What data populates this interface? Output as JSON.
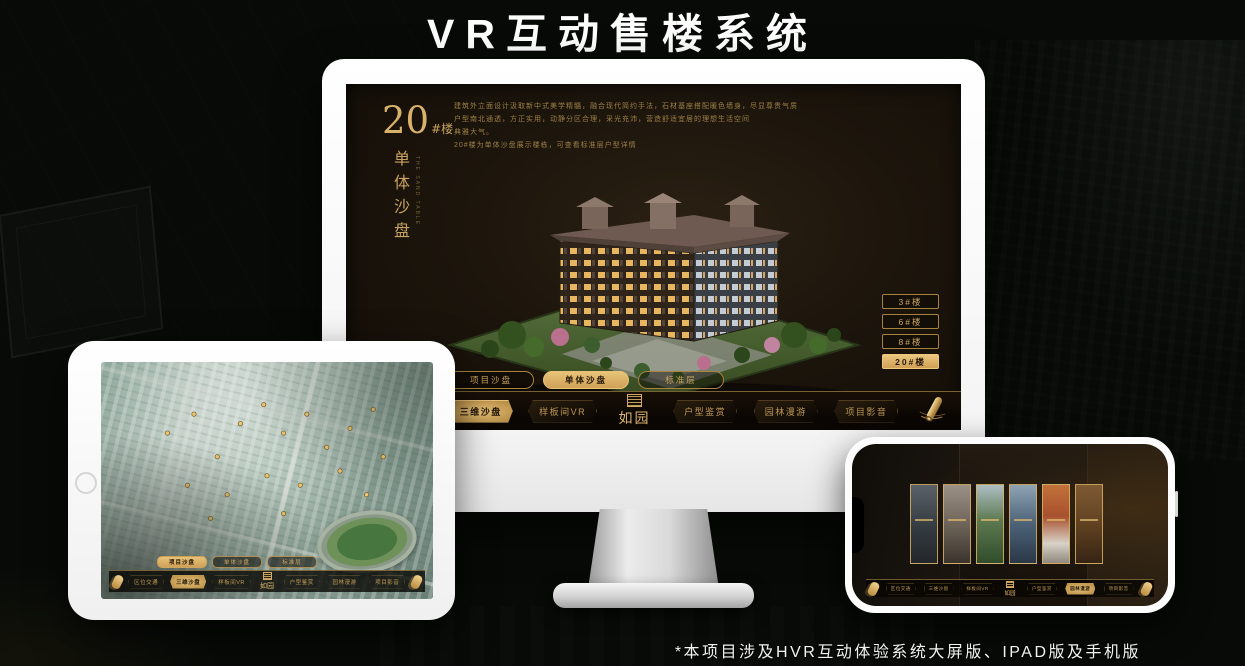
{
  "title": "VR互动售楼系统",
  "footnote": "*本项目涉及HVR互动体验系统大屏版、IPAD版及手机版",
  "colors": {
    "gold": "#d3aa60",
    "gold_active_fill": "#d9ab5e",
    "screen_bg": "#1a130b"
  },
  "monitor": {
    "building_no": "20",
    "building_no_unit": "#楼",
    "section_title": "单体沙盘",
    "section_title_en": "THE SAND TABLE",
    "description_lines": [
      {
        "text": "建筑外立面设计汲取新中式美学精髓，融合现代简约手法，石材基座搭配暖色墙身，尽显尊贵气质"
      },
      {
        "text": "户型南北通透，方正实用，动静分区合理，采光充沛，营造舒适宜居的理想生活空间"
      },
      {
        "text": "典雅大气。"
      },
      {
        "text": "20#楼为单体沙盘展示楼栋，可查看标准层户型详情"
      }
    ],
    "floor_buttons": [
      {
        "label": "3#楼",
        "active": false
      },
      {
        "label": "6#楼",
        "active": false
      },
      {
        "label": "8#楼",
        "active": false
      },
      {
        "label": "20#楼",
        "active": true
      }
    ],
    "sub_tabs": [
      {
        "label": "项目沙盘",
        "active": false
      },
      {
        "label": "单体沙盘",
        "active": true
      },
      {
        "label": "标准层",
        "active": false
      }
    ],
    "nav_left": [
      {
        "label": "区位交通",
        "active": false
      },
      {
        "label": "三维沙盘",
        "active": true
      },
      {
        "label": "样板间VR",
        "active": false
      }
    ],
    "nav_right": [
      {
        "label": "户型鉴赏",
        "active": false
      },
      {
        "label": "园林漫游",
        "active": false
      },
      {
        "label": "项目影音",
        "active": false
      }
    ],
    "logo": "如园",
    "scroll_icon": "scroll-menu"
  },
  "tablet": {
    "sub_tabs": [
      {
        "label": "项目沙盘",
        "active": true
      },
      {
        "label": "单体沙盘",
        "active": false
      },
      {
        "label": "标准层",
        "active": false
      }
    ],
    "nav_left": [
      {
        "label": "区位交通",
        "active": false
      },
      {
        "label": "三维沙盘",
        "active": true
      },
      {
        "label": "样板间VR",
        "active": false
      }
    ],
    "nav_right": [
      {
        "label": "户型鉴赏",
        "active": false
      },
      {
        "label": "园林漫游",
        "active": false
      },
      {
        "label": "项目影音",
        "active": false
      }
    ],
    "logo": "如园"
  },
  "phone": {
    "nav_left": [
      {
        "label": "区位交通",
        "active": false
      },
      {
        "label": "三维沙盘",
        "active": false
      },
      {
        "label": "样板间VR",
        "active": false
      }
    ],
    "nav_right": [
      {
        "label": "户型鉴赏",
        "active": false
      },
      {
        "label": "园林漫游",
        "active": true
      },
      {
        "label": "项目影音",
        "active": false
      }
    ],
    "logo": "如园",
    "gallery_card_count": 6
  }
}
